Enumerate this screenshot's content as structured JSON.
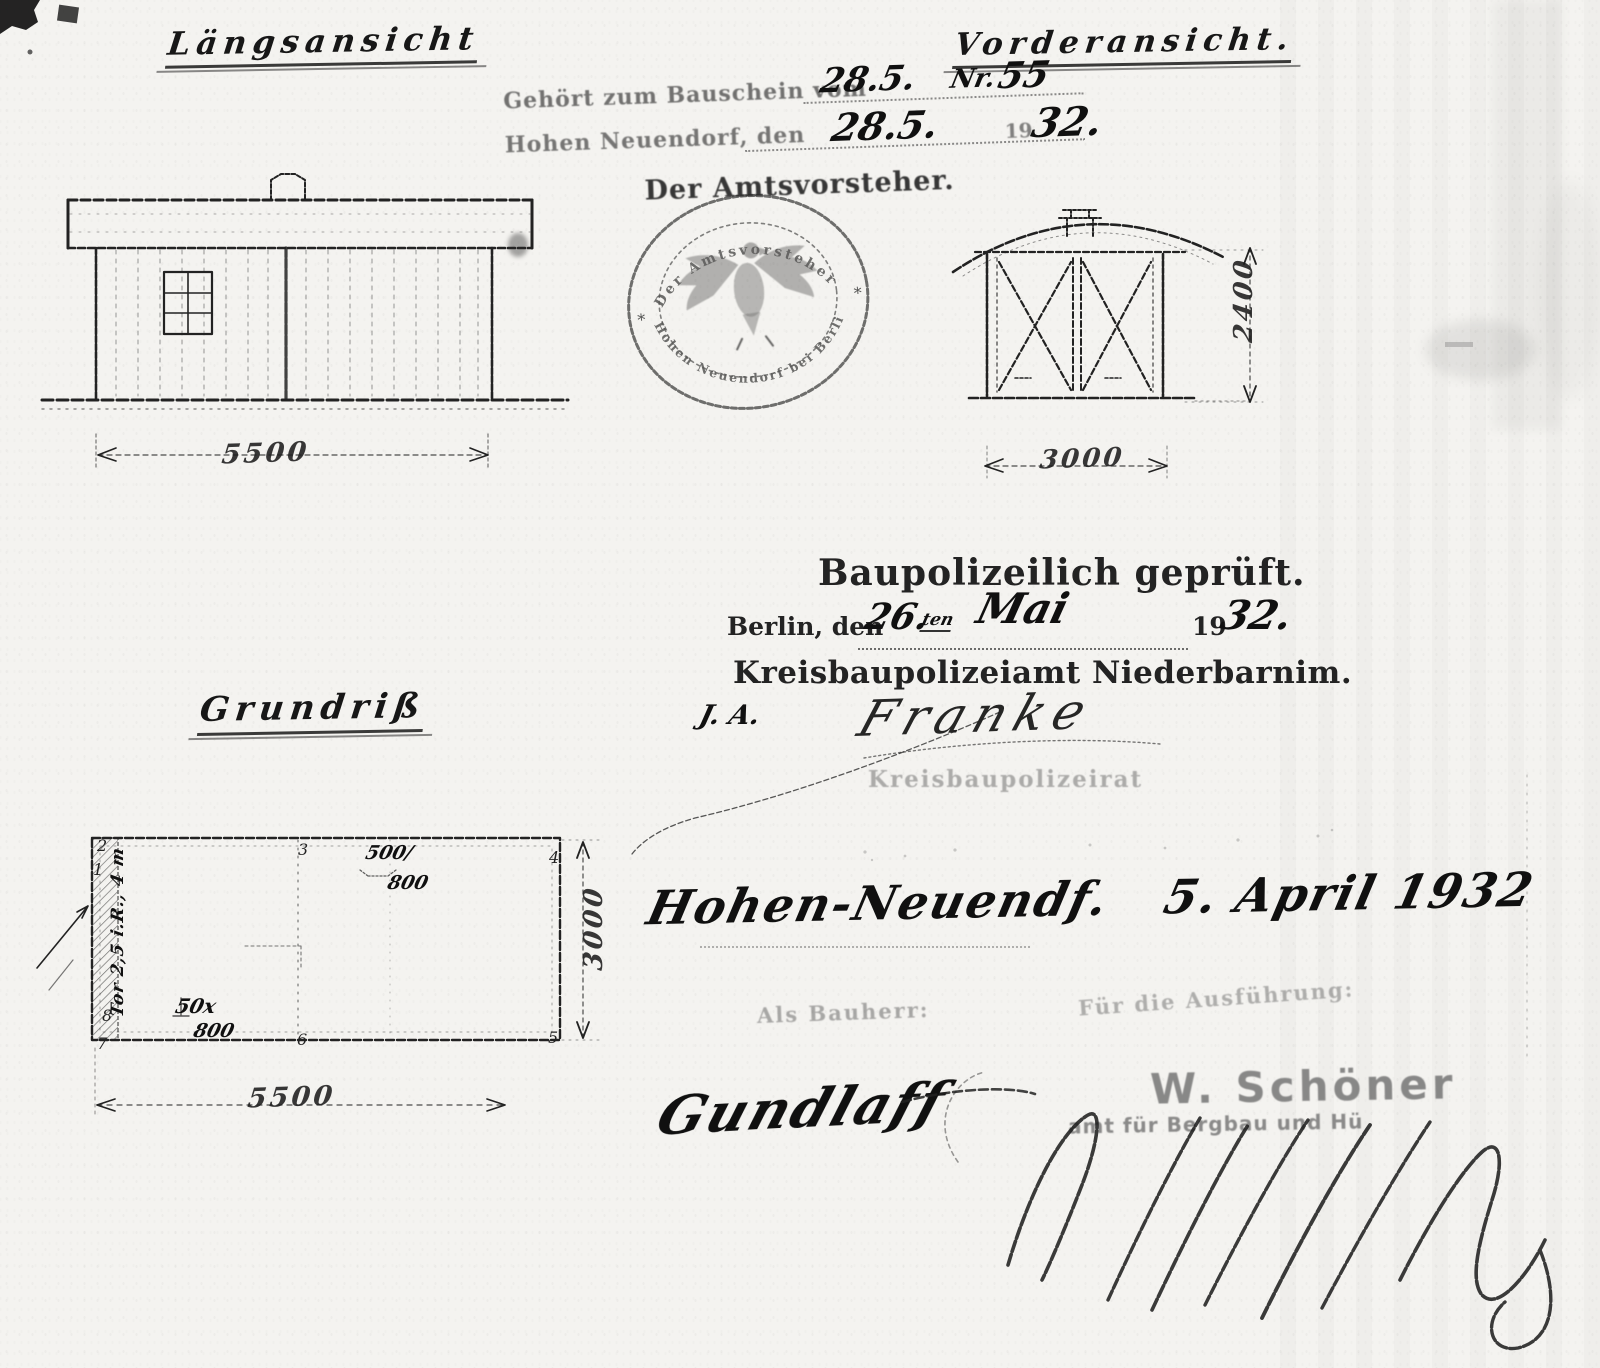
{
  "titles": {
    "laengsansicht": "Längsansicht",
    "vorderansicht": "Vorderansicht.",
    "grundriss": "Grundriß"
  },
  "permit_note": {
    "line1_printed": "Gehört zum Bauschein vom",
    "line1_date": "28.5.",
    "line1_nr": "Nr.",
    "line1_nr_value": "55",
    "line2_printed": "Hohen Neuendorf, den",
    "line2_date": "28.5.",
    "line2_year_printed": "19",
    "line2_year_hand": "32.",
    "line3": "Der Amtsvorsteher."
  },
  "round_stamp": {
    "arc_top": "Der Amtsvorsteher",
    "arc_bottom": "Hohen Neuendorf bei Berlin",
    "star_left": "*",
    "star_right": "*"
  },
  "approval": {
    "heading": "Baupolizeilich geprüft.",
    "place_printed": "Berlin, den",
    "day_hand": "26.",
    "day_suffix": "ten",
    "month_hand": "Mai",
    "year_printed": "19",
    "year_hand": "32.",
    "office": "Kreisbaupolizeiamt Niederbarnim.",
    "ia": "J. A.",
    "signature": "Franke",
    "faint_stamp": "Kreisbaupolizeirat"
  },
  "handwritten_date": {
    "place": "Hohen-Neuendf.",
    "date": "5. April 1932"
  },
  "bottom": {
    "left_label": "Als Bauherr:",
    "right_label": "Für die Ausführung:",
    "stamp_name": "W. Schöner",
    "stamp_line2": "amt für Bergbau und Hü",
    "left_signature": "Gundlaff"
  },
  "dims": {
    "laengs_width": "5500",
    "front_width": "3000",
    "front_height": "2400",
    "plan_width": "5500",
    "plan_height": "3000",
    "plan_gate": "Tor 2,5 i.R., 4 m",
    "post_a1": "500/",
    "post_a2": "800",
    "post_b1": "50x",
    "post_b2": "800",
    "corners": {
      "c1": "1",
      "c2": "2",
      "c3": "3",
      "c4": "4",
      "c5": "5",
      "c6": "6",
      "c7": "7",
      "c8": "8"
    }
  }
}
